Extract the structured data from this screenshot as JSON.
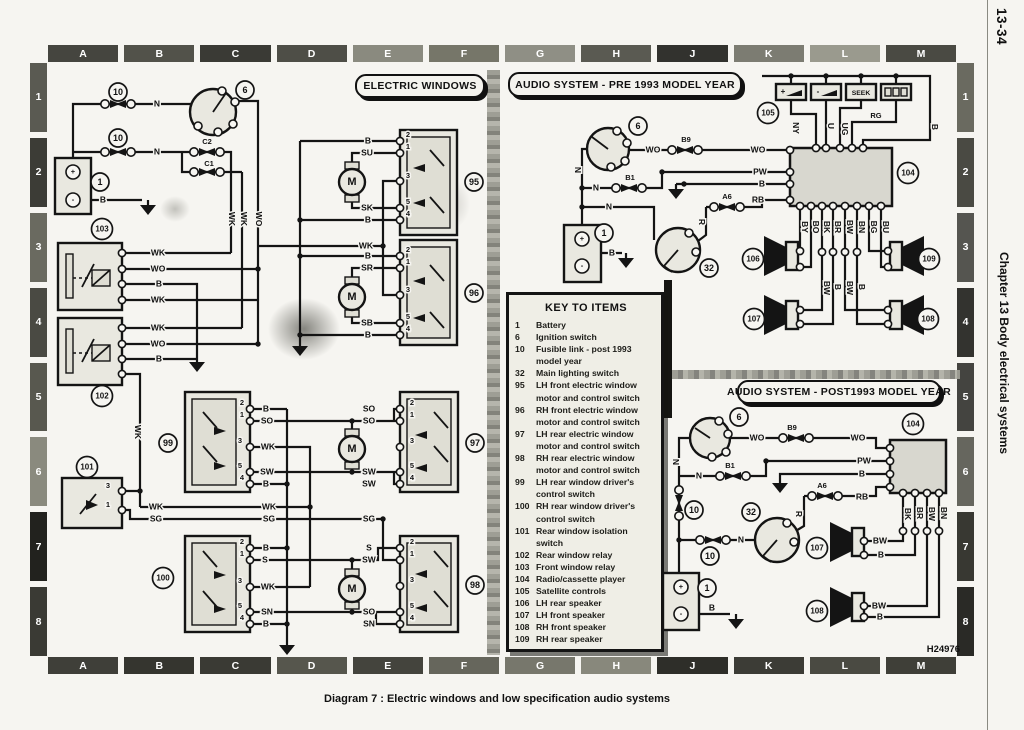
{
  "page": {
    "number": "13-34",
    "chapter": "Chapter 13 Body electrical systems",
    "caption": "Diagram 7 : Electric windows and low specification audio systems",
    "figure_code": "H24976"
  },
  "grid": {
    "top": [
      "A",
      "B",
      "C",
      "D",
      "E",
      "F",
      "G",
      "H",
      "J",
      "K",
      "L",
      "M"
    ],
    "bottom": [
      "A",
      "B",
      "C",
      "D",
      "E",
      "F",
      "G",
      "H",
      "J",
      "K",
      "L",
      "M"
    ],
    "left": [
      "1",
      "2",
      "3",
      "4",
      "5",
      "6",
      "7",
      "8"
    ],
    "right": [
      "1",
      "2",
      "3",
      "4",
      "5",
      "6",
      "7",
      "8"
    ]
  },
  "titles": {
    "electric_windows": "ELECTRIC WINDOWS",
    "audio_pre": "AUDIO SYSTEM - PRE 1993 MODEL YEAR",
    "audio_post": "AUDIO SYSTEM - POST1993 MODEL YEAR"
  },
  "key": {
    "title": "KEY TO ITEMS",
    "items": [
      {
        "num": "1",
        "text": "Battery"
      },
      {
        "num": "6",
        "text": "Ignition switch"
      },
      {
        "num": "10",
        "text": "Fusible link - post 1993 model year"
      },
      {
        "num": "32",
        "text": "Main lighting switch"
      },
      {
        "num": "95",
        "text": "LH front electric window motor and control switch"
      },
      {
        "num": "96",
        "text": "RH front electric window motor and control switch"
      },
      {
        "num": "97",
        "text": "LH rear electric window motor and control switch"
      },
      {
        "num": "98",
        "text": "RH rear electric window motor and control switch"
      },
      {
        "num": "99",
        "text": "LH rear window driver's control switch"
      },
      {
        "num": "100",
        "text": "RH rear window driver's control switch"
      },
      {
        "num": "101",
        "text": "Rear window isolation switch"
      },
      {
        "num": "102",
        "text": "Rear window relay"
      },
      {
        "num": "103",
        "text": "Front window relay"
      },
      {
        "num": "104",
        "text": "Radio/cassette player"
      },
      {
        "num": "105",
        "text": "Satellite controls"
      },
      {
        "num": "106",
        "text": "LH rear speaker"
      },
      {
        "num": "107",
        "text": "LH front speaker"
      },
      {
        "num": "108",
        "text": "RH front speaker"
      },
      {
        "num": "109",
        "text": "RH rear speaker"
      }
    ]
  },
  "satellite": {
    "plus": "+",
    "minus": "-",
    "seek": "SEEK"
  },
  "schematic": {
    "refs": [
      {
        "n": "10",
        "x": 118,
        "y": 92
      },
      {
        "n": "10",
        "x": 118,
        "y": 138
      },
      {
        "n": "6",
        "x": 245,
        "y": 90
      },
      {
        "n": "1",
        "x": 100,
        "y": 182
      },
      {
        "n": "103",
        "x": 102,
        "y": 229
      },
      {
        "n": "102",
        "x": 102,
        "y": 396
      },
      {
        "n": "101",
        "x": 87,
        "y": 467
      },
      {
        "n": "99",
        "x": 168,
        "y": 443
      },
      {
        "n": "100",
        "x": 163,
        "y": 578
      },
      {
        "n": "95",
        "x": 474,
        "y": 182
      },
      {
        "n": "96",
        "x": 474,
        "y": 293
      },
      {
        "n": "97",
        "x": 475,
        "y": 443
      },
      {
        "n": "98",
        "x": 475,
        "y": 585
      },
      {
        "n": "6",
        "x": 638,
        "y": 126
      },
      {
        "n": "1",
        "x": 604,
        "y": 233
      },
      {
        "n": "32",
        "x": 709,
        "y": 268
      },
      {
        "n": "105",
        "x": 768,
        "y": 113
      },
      {
        "n": "104",
        "x": 908,
        "y": 173
      },
      {
        "n": "106",
        "x": 753,
        "y": 259
      },
      {
        "n": "109",
        "x": 929,
        "y": 259
      },
      {
        "n": "107",
        "x": 754,
        "y": 319
      },
      {
        "n": "108",
        "x": 928,
        "y": 319
      },
      {
        "n": "6",
        "x": 739,
        "y": 417
      },
      {
        "n": "10",
        "x": 694,
        "y": 510
      },
      {
        "n": "10",
        "x": 710,
        "y": 556
      },
      {
        "n": "32",
        "x": 751,
        "y": 512
      },
      {
        "n": "1",
        "x": 707,
        "y": 588
      },
      {
        "n": "104",
        "x": 913,
        "y": 424
      },
      {
        "n": "107",
        "x": 817,
        "y": 548
      },
      {
        "n": "108",
        "x": 817,
        "y": 611
      }
    ],
    "labels": [
      {
        "t": "N",
        "x": 157,
        "y": 104
      },
      {
        "t": "N",
        "x": 157,
        "y": 152
      },
      {
        "t": "C2",
        "x": 207,
        "y": 142,
        "s": 1
      },
      {
        "t": "C1",
        "x": 209,
        "y": 164,
        "s": 1
      },
      {
        "t": "B",
        "x": 103,
        "y": 200
      },
      {
        "t": "WK",
        "x": 231,
        "y": 219,
        "r": 1
      },
      {
        "t": "WK",
        "x": 243,
        "y": 219,
        "r": 1
      },
      {
        "t": "WO",
        "x": 258,
        "y": 219,
        "r": 1
      },
      {
        "t": "WK",
        "x": 158,
        "y": 253
      },
      {
        "t": "WO",
        "x": 158,
        "y": 269
      },
      {
        "t": "B",
        "x": 159,
        "y": 284
      },
      {
        "t": "WK",
        "x": 158,
        "y": 300
      },
      {
        "t": "WK",
        "x": 158,
        "y": 328
      },
      {
        "t": "WO",
        "x": 158,
        "y": 344
      },
      {
        "t": "B",
        "x": 159,
        "y": 359
      },
      {
        "t": "WK",
        "x": 137,
        "y": 432,
        "r": 1
      },
      {
        "t": "WK",
        "x": 156,
        "y": 507
      },
      {
        "t": "SG",
        "x": 156,
        "y": 519
      },
      {
        "t": "WK",
        "x": 269,
        "y": 507
      },
      {
        "t": "SG",
        "x": 269,
        "y": 519
      },
      {
        "t": "B",
        "x": 368,
        "y": 141
      },
      {
        "t": "SU",
        "x": 367,
        "y": 153
      },
      {
        "t": "SK",
        "x": 367,
        "y": 208
      },
      {
        "t": "B",
        "x": 368,
        "y": 220
      },
      {
        "t": "WK",
        "x": 366,
        "y": 246
      },
      {
        "t": "B",
        "x": 368,
        "y": 256
      },
      {
        "t": "SR",
        "x": 367,
        "y": 268
      },
      {
        "t": "SB",
        "x": 367,
        "y": 323
      },
      {
        "t": "B",
        "x": 368,
        "y": 335
      },
      {
        "t": "B",
        "x": 266,
        "y": 409
      },
      {
        "t": "SO",
        "x": 267,
        "y": 421
      },
      {
        "t": "WK",
        "x": 268,
        "y": 447
      },
      {
        "t": "SW",
        "x": 267,
        "y": 472
      },
      {
        "t": "B",
        "x": 266,
        "y": 484
      },
      {
        "t": "B",
        "x": 266,
        "y": 548
      },
      {
        "t": "S",
        "x": 265,
        "y": 560
      },
      {
        "t": "WK",
        "x": 268,
        "y": 587
      },
      {
        "t": "SN",
        "x": 267,
        "y": 612
      },
      {
        "t": "B",
        "x": 266,
        "y": 624
      },
      {
        "t": "SO",
        "x": 369,
        "y": 409
      },
      {
        "t": "SO",
        "x": 369,
        "y": 421
      },
      {
        "t": "SW",
        "x": 369,
        "y": 472
      },
      {
        "t": "SW",
        "x": 369,
        "y": 484
      },
      {
        "t": "SG",
        "x": 369,
        "y": 519
      },
      {
        "t": "S",
        "x": 369,
        "y": 548
      },
      {
        "t": "SW",
        "x": 369,
        "y": 560
      },
      {
        "t": "SO",
        "x": 369,
        "y": 612
      },
      {
        "t": "SN",
        "x": 369,
        "y": 624
      },
      {
        "t": "M",
        "x": 352,
        "y": 182,
        "m": 1
      },
      {
        "t": "M",
        "x": 352,
        "y": 297,
        "m": 1
      },
      {
        "t": "M",
        "x": 352,
        "y": 449,
        "m": 1
      },
      {
        "t": "M",
        "x": 352,
        "y": 589,
        "m": 1
      },
      {
        "t": "+",
        "x": 73,
        "y": 172,
        "s": 1
      },
      {
        "t": "-",
        "x": 73,
        "y": 200,
        "s": 1
      },
      {
        "t": "2",
        "x": 408,
        "y": 135,
        "s": 1
      },
      {
        "t": "1",
        "x": 408,
        "y": 147,
        "s": 1
      },
      {
        "t": "3",
        "x": 408,
        "y": 176,
        "s": 1
      },
      {
        "t": "5",
        "x": 408,
        "y": 202,
        "s": 1
      },
      {
        "t": "4",
        "x": 408,
        "y": 214,
        "s": 1
      },
      {
        "t": "2",
        "x": 408,
        "y": 250,
        "s": 1
      },
      {
        "t": "1",
        "x": 408,
        "y": 262,
        "s": 1
      },
      {
        "t": "3",
        "x": 408,
        "y": 290,
        "s": 1
      },
      {
        "t": "5",
        "x": 408,
        "y": 317,
        "s": 1
      },
      {
        "t": "4",
        "x": 408,
        "y": 329,
        "s": 1
      },
      {
        "t": "2",
        "x": 412,
        "y": 403,
        "s": 1
      },
      {
        "t": "1",
        "x": 412,
        "y": 415,
        "s": 1
      },
      {
        "t": "3",
        "x": 412,
        "y": 441,
        "s": 1
      },
      {
        "t": "5",
        "x": 412,
        "y": 466,
        "s": 1
      },
      {
        "t": "4",
        "x": 412,
        "y": 478,
        "s": 1
      },
      {
        "t": "2",
        "x": 412,
        "y": 542,
        "s": 1
      },
      {
        "t": "1",
        "x": 412,
        "y": 554,
        "s": 1
      },
      {
        "t": "3",
        "x": 412,
        "y": 580,
        "s": 1
      },
      {
        "t": "5",
        "x": 412,
        "y": 606,
        "s": 1
      },
      {
        "t": "4",
        "x": 412,
        "y": 618,
        "s": 1
      },
      {
        "t": "2",
        "x": 242,
        "y": 403,
        "s": 1
      },
      {
        "t": "1",
        "x": 242,
        "y": 415,
        "s": 1
      },
      {
        "t": "3",
        "x": 240,
        "y": 441,
        "s": 1
      },
      {
        "t": "5",
        "x": 240,
        "y": 466,
        "s": 1
      },
      {
        "t": "4",
        "x": 242,
        "y": 478,
        "s": 1
      },
      {
        "t": "2",
        "x": 242,
        "y": 542,
        "s": 1
      },
      {
        "t": "1",
        "x": 242,
        "y": 554,
        "s": 1
      },
      {
        "t": "3",
        "x": 240,
        "y": 581,
        "s": 1
      },
      {
        "t": "5",
        "x": 240,
        "y": 606,
        "s": 1
      },
      {
        "t": "4",
        "x": 242,
        "y": 618,
        "s": 1
      },
      {
        "t": "3",
        "x": 108,
        "y": 486,
        "s": 1
      },
      {
        "t": "1",
        "x": 108,
        "y": 505,
        "s": 1
      },
      {
        "t": "WO",
        "x": 653,
        "y": 150
      },
      {
        "t": "B9",
        "x": 686,
        "y": 140,
        "s": 1
      },
      {
        "t": "WO",
        "x": 758,
        "y": 150
      },
      {
        "t": "PW",
        "x": 760,
        "y": 172
      },
      {
        "t": "B",
        "x": 762,
        "y": 184
      },
      {
        "t": "B1",
        "x": 630,
        "y": 178,
        "s": 1
      },
      {
        "t": "N",
        "x": 596,
        "y": 188
      },
      {
        "t": "N",
        "x": 609,
        "y": 207
      },
      {
        "t": "A6",
        "x": 727,
        "y": 197,
        "s": 1
      },
      {
        "t": "RB",
        "x": 758,
        "y": 200
      },
      {
        "t": "R",
        "x": 701,
        "y": 222,
        "r": 1
      },
      {
        "t": "N",
        "x": 577,
        "y": 170,
        "r": 1
      },
      {
        "t": "B",
        "x": 612,
        "y": 253
      },
      {
        "t": "+",
        "x": 582,
        "y": 239,
        "s": 1
      },
      {
        "t": "-",
        "x": 582,
        "y": 266,
        "s": 1
      },
      {
        "t": "NY",
        "x": 795,
        "y": 128,
        "r": 1
      },
      {
        "t": "U",
        "x": 830,
        "y": 126,
        "r": 1
      },
      {
        "t": "UG",
        "x": 844,
        "y": 129,
        "r": 1
      },
      {
        "t": "RG",
        "x": 876,
        "y": 116,
        "s": 1
      },
      {
        "t": "B",
        "x": 934,
        "y": 127,
        "r": 1
      },
      {
        "t": "BY",
        "x": 804,
        "y": 227,
        "r": 1
      },
      {
        "t": "BO",
        "x": 815,
        "y": 227,
        "r": 1
      },
      {
        "t": "BK",
        "x": 826,
        "y": 227,
        "r": 1
      },
      {
        "t": "BR",
        "x": 837,
        "y": 227,
        "r": 1
      },
      {
        "t": "BW",
        "x": 849,
        "y": 227,
        "r": 1
      },
      {
        "t": "BN",
        "x": 861,
        "y": 227,
        "r": 1
      },
      {
        "t": "BG",
        "x": 873,
        "y": 227,
        "r": 1
      },
      {
        "t": "BU",
        "x": 885,
        "y": 227,
        "r": 1
      },
      {
        "t": "BW",
        "x": 826,
        "y": 288,
        "r": 1
      },
      {
        "t": "B",
        "x": 837,
        "y": 287,
        "r": 1
      },
      {
        "t": "BW",
        "x": 849,
        "y": 288,
        "r": 1
      },
      {
        "t": "B",
        "x": 861,
        "y": 287,
        "r": 1
      },
      {
        "t": "WO",
        "x": 757,
        "y": 438
      },
      {
        "t": "B9",
        "x": 792,
        "y": 428,
        "s": 1
      },
      {
        "t": "WO",
        "x": 858,
        "y": 438
      },
      {
        "t": "PW",
        "x": 864,
        "y": 461
      },
      {
        "t": "B",
        "x": 862,
        "y": 474
      },
      {
        "t": "B1",
        "x": 730,
        "y": 466,
        "s": 1
      },
      {
        "t": "N",
        "x": 699,
        "y": 476
      },
      {
        "t": "A6",
        "x": 822,
        "y": 486,
        "s": 1
      },
      {
        "t": "RB",
        "x": 862,
        "y": 497
      },
      {
        "t": "R",
        "x": 798,
        "y": 514,
        "r": 1
      },
      {
        "t": "N",
        "x": 675,
        "y": 462,
        "r": 1
      },
      {
        "t": "N",
        "x": 741,
        "y": 540
      },
      {
        "t": "B",
        "x": 712,
        "y": 608
      },
      {
        "t": "+",
        "x": 681,
        "y": 587,
        "s": 1
      },
      {
        "t": "-",
        "x": 681,
        "y": 614,
        "s": 1
      },
      {
        "t": "BK",
        "x": 907,
        "y": 514,
        "r": 1
      },
      {
        "t": "BR",
        "x": 919,
        "y": 513,
        "r": 1
      },
      {
        "t": "BW",
        "x": 931,
        "y": 514,
        "r": 1
      },
      {
        "t": "BN",
        "x": 943,
        "y": 513,
        "r": 1
      },
      {
        "t": "BW",
        "x": 880,
        "y": 541
      },
      {
        "t": "B",
        "x": 881,
        "y": 555
      },
      {
        "t": "BW",
        "x": 879,
        "y": 606
      },
      {
        "t": "B",
        "x": 880,
        "y": 617
      }
    ]
  }
}
